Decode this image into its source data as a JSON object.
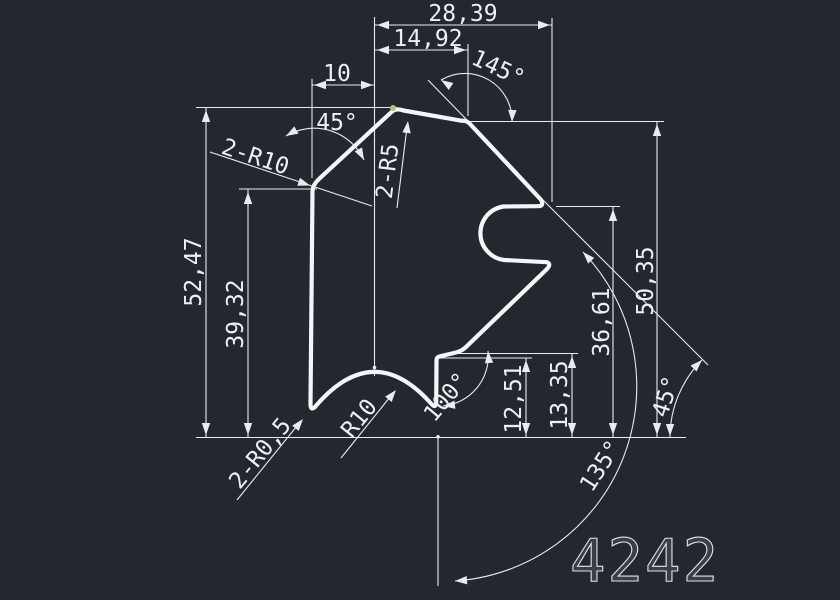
{
  "canvas": {
    "background": "#23282f",
    "line_color": "#e8ebef",
    "text_color": "#eceff3",
    "profile_color": "#f3f5f8",
    "grip_color": "#b9c06f"
  },
  "labels": {
    "dim_28_39": "28,39",
    "dim_14_92": "14,92",
    "dim_10": "10",
    "dim_52_47": "52,47",
    "dim_39_32": "39,32",
    "dim_12_51": "12,51",
    "dim_13_35": "13,35",
    "dim_36_61": "36,61",
    "dim_50_35": "50,35",
    "angle_145": "145°",
    "angle_45_top": "45°",
    "angle_100": "100°",
    "angle_135": "135°",
    "angle_45_right": "45°",
    "radius_top_left": "2-R10",
    "radius_apex": "2-R5",
    "radius_arch": "R10",
    "radius_bottom_left": "2-R0,5",
    "part_number": "4242"
  }
}
